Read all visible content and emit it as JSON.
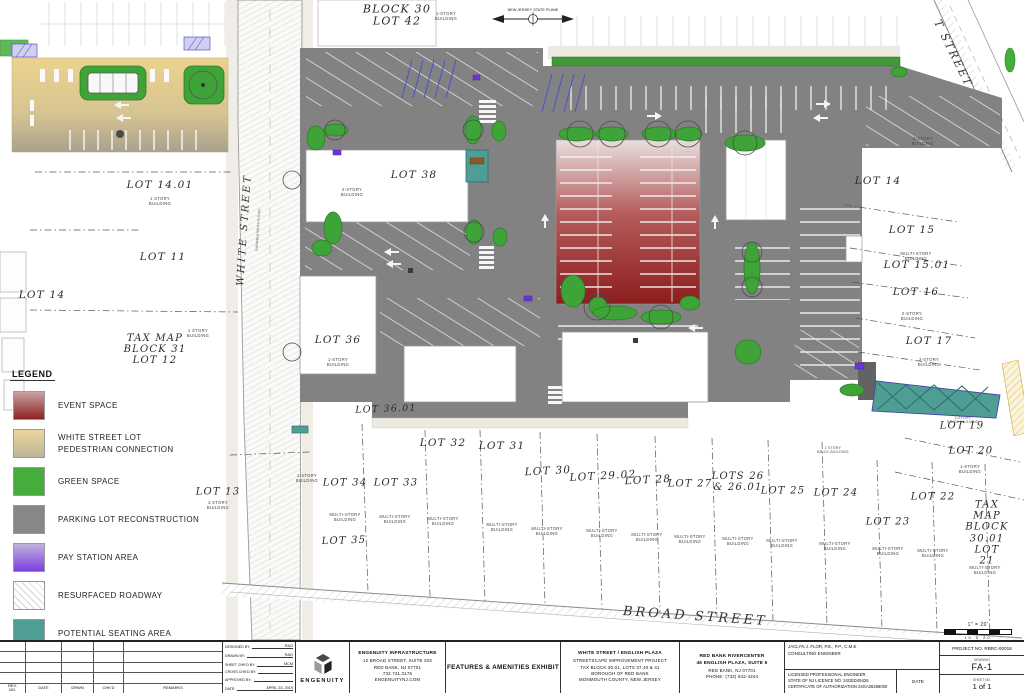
{
  "legend": {
    "title": "LEGEND",
    "items": [
      {
        "label": "EVENT SPACE",
        "label2": "",
        "style": "gradient",
        "colors": [
          "#c9a3a3",
          "#8e2121"
        ]
      },
      {
        "label": "WHITE STREET LOT",
        "label2": "PEDESTRIAN CONNECTION",
        "style": "gradient",
        "colors": [
          "#ecd79b",
          "#bdb49b"
        ]
      },
      {
        "label": "GREEN SPACE",
        "label2": "",
        "style": "solid",
        "colors": [
          "#44ad3c",
          "#44ad3c"
        ]
      },
      {
        "label": "PARKING LOT RECONSTRUCTION",
        "label2": "",
        "style": "solid",
        "colors": [
          "#878787",
          "#878787"
        ]
      },
      {
        "label": "PAY STATION AREA",
        "label2": "",
        "style": "gradient",
        "colors": [
          "#c0b3dc",
          "#7b3fe0"
        ]
      },
      {
        "label": "RESURFACED ROADWAY",
        "label2": "",
        "style": "hatch",
        "colors": [
          "#ffffff",
          "#ffffff"
        ]
      },
      {
        "label": "POTENTIAL SEATING AREA",
        "label2": "",
        "style": "solid",
        "colors": [
          "#4f9e96",
          "#4f9e96"
        ]
      }
    ]
  },
  "plan": {
    "north_label": "NEW JERSEY STATE PLANE",
    "streets": {
      "white": "WHITE STREET",
      "white_sub": "(VARIABLE WIDTH R.O.W.)",
      "broad": "BROAD STREET",
      "right": "T STREET"
    },
    "scale": {
      "ratio": "1\" = 20'",
      "ticks": "10   0        20"
    },
    "lots": [
      {
        "t": "BLOCK 30\nLOT 42",
        "x": 397,
        "y": 16,
        "fs": 11
      },
      {
        "t": "LOT 14.01",
        "x": 160,
        "y": 186
      },
      {
        "t": "LOT 11",
        "x": 163,
        "y": 258
      },
      {
        "t": "LOT 14",
        "x": 42,
        "y": 296
      },
      {
        "t": "TAX MAP\nBLOCK 31\nLOT 12",
        "x": 155,
        "y": 350,
        "fs": 10
      },
      {
        "t": "LOT 13",
        "x": 218,
        "y": 492,
        "fs": 10
      },
      {
        "t": "LOT 38",
        "x": 414,
        "y": 176
      },
      {
        "t": "LOT 36",
        "x": 338,
        "y": 341
      },
      {
        "t": "LOT 36.01",
        "x": 386,
        "y": 410,
        "fs": 9.5,
        "rot": -2
      },
      {
        "t": "LOT 34",
        "x": 345,
        "y": 483,
        "fs": 10
      },
      {
        "t": "LOT 33",
        "x": 396,
        "y": 483,
        "fs": 10
      },
      {
        "t": "LOT 35",
        "x": 344,
        "y": 541,
        "fs": 10,
        "rot": -2
      },
      {
        "t": "LOT 32",
        "x": 443,
        "y": 444
      },
      {
        "t": "LOT 31",
        "x": 502,
        "y": 447
      },
      {
        "t": "LOT 30",
        "x": 548,
        "y": 472,
        "rot": -3
      },
      {
        "t": "LOT 29.02",
        "x": 603,
        "y": 477,
        "rot": -3
      },
      {
        "t": "LOT 28",
        "x": 648,
        "y": 481,
        "rot": -3
      },
      {
        "t": "LOT 27",
        "x": 690,
        "y": 484,
        "fs": 10
      },
      {
        "t": "LOTS 26\n& 26.01",
        "x": 738,
        "y": 482,
        "fs": 10
      },
      {
        "t": "LOT 25",
        "x": 783,
        "y": 491,
        "fs": 10
      },
      {
        "t": "LOT 24",
        "x": 836,
        "y": 493,
        "fs": 10
      },
      {
        "t": "LOT 23",
        "x": 888,
        "y": 522,
        "fs": 10
      },
      {
        "t": "LOT 22",
        "x": 933,
        "y": 497,
        "fs": 10
      },
      {
        "t": "LOT 20",
        "x": 971,
        "y": 451,
        "fs": 10
      },
      {
        "t": "LOT 19",
        "x": 962,
        "y": 426,
        "fs": 10
      },
      {
        "t": "TAX MAP\nBLOCK 30.01\nLOT 21",
        "x": 987,
        "y": 533,
        "fs": 10
      },
      {
        "t": "LOT 14",
        "x": 878,
        "y": 182
      },
      {
        "t": "LOT 15",
        "x": 912,
        "y": 231
      },
      {
        "t": "LOT 15.01",
        "x": 917,
        "y": 266
      },
      {
        "t": "LOT 16",
        "x": 916,
        "y": 293
      },
      {
        "t": "LOT 17",
        "x": 929,
        "y": 342
      }
    ],
    "buildings": [
      {
        "t": "1 STORY\nBUILDING",
        "x": 160,
        "y": 201
      },
      {
        "t": "2-STORY\nBUILDING",
        "x": 352,
        "y": 192
      },
      {
        "t": "1-STORY\nBUILDING",
        "x": 446,
        "y": 16
      },
      {
        "t": "1-STORY\nBUILDING",
        "x": 338,
        "y": 362
      },
      {
        "t": "2 STORY\nBUILDING",
        "x": 218,
        "y": 505
      },
      {
        "t": "1 STORY\nBUILDING",
        "x": 198,
        "y": 333
      },
      {
        "t": "1-STORY\nBUILDING",
        "x": 307,
        "y": 478
      },
      {
        "t": "2-STORY\nBUILDING",
        "x": 923,
        "y": 141
      },
      {
        "t": "MULTI-STORY\nBUILDING",
        "x": 916,
        "y": 256
      },
      {
        "t": "2-STORY\nBUILDING",
        "x": 912,
        "y": 316
      },
      {
        "t": "2-STORY\nBUILDING",
        "x": 929,
        "y": 362
      },
      {
        "t": "2 STORY\nBRICK BUILDING",
        "x": 833,
        "y": 450,
        "fs": 3.4
      },
      {
        "t": "2-STORY\nBRICK BUILDING",
        "x": 963,
        "y": 420,
        "fs": 3.4
      },
      {
        "t": "1-STORY\nBUILDING",
        "x": 970,
        "y": 469
      },
      {
        "t": "MULTI-STORY\nBUILDING",
        "x": 345,
        "y": 517
      },
      {
        "t": "MULTI-STORY\nBUILDING",
        "x": 395,
        "y": 519
      },
      {
        "t": "MULTI-STORY\nBUILDING",
        "x": 443,
        "y": 521
      },
      {
        "t": "MULTI-STORY\nBUILDING",
        "x": 502,
        "y": 527
      },
      {
        "t": "MULTI-STORY\nBUILDING",
        "x": 547,
        "y": 531
      },
      {
        "t": "MULTI-STORY\nBUILDING",
        "x": 602,
        "y": 533
      },
      {
        "t": "MULTI-STORY\nBUILDING",
        "x": 647,
        "y": 537
      },
      {
        "t": "MULTI-STORY\nBUILDING",
        "x": 690,
        "y": 539
      },
      {
        "t": "MULTI-STORY\nBUILDING",
        "x": 738,
        "y": 541
      },
      {
        "t": "MULTI-STORY\nBUILDING",
        "x": 782,
        "y": 543
      },
      {
        "t": "MULTI-STORY\nBUILDING",
        "x": 835,
        "y": 546
      },
      {
        "t": "MULTI-STORY\nBUILDING",
        "x": 888,
        "y": 551
      },
      {
        "t": "MULTI-STORY\nBUILDING",
        "x": 933,
        "y": 553
      },
      {
        "t": "MULTI-STORY\nBUILDING",
        "x": 985,
        "y": 570
      }
    ]
  },
  "title_block": {
    "rev_table": {
      "headers": [
        "REV.\nNO.",
        "DATE",
        "DRWN",
        "CHK'D",
        "REMARKS"
      ]
    },
    "approvals": [
      {
        "label": "DESIGNED BY:",
        "value": "RAO"
      },
      {
        "label": "DRAWN BY:",
        "value": "RAO"
      },
      {
        "label": "SHEET CHK'D BY:",
        "value": "MCM"
      },
      {
        "label": "CROSS CHK'D BY:",
        "value": ""
      },
      {
        "label": "APPROVED BY:",
        "value": ""
      },
      {
        "label": "DATE:",
        "value": "APRIL 23, 2019"
      }
    ],
    "logo": {
      "name": "ENGENUITY"
    },
    "firm": {
      "name": "ENGENUITY INFRASTRUCTURE",
      "address1": "12 BROAD STREET, SUITE 203",
      "address2": "RED BANK, NJ 07701",
      "phone": "732.741.3176",
      "web": "ENGENUITYNJ.COM"
    },
    "exhibit_title": "FEATURES & AMENITIES EXHIBIT",
    "project": {
      "line1": "WHITE STREET / ENGLISH PLAZA",
      "line2": "STREETSCAPE IMPROVEMENT PROJECT",
      "line3": "TAX BLOCK 30.01, LOTS 37,40 & 41",
      "line4": "BOROUGH OF RED BANK",
      "line5": "MONMOUTH COUNTY, NEW JERSEY"
    },
    "client": {
      "name": "RED BANK RIVERCENTER",
      "address1": "46 ENGLISH PLAZA, SUITE 6",
      "address2": "RED BANK, NJ  07701",
      "phone": "PHONE: (732) 842-4244"
    },
    "engineer": {
      "name": "JACLYN J. FLOR, P.E., P.P., C.M.E",
      "title": "CONSULTING ENGINEER",
      "license1": "LICENSED PROFESSIONAL ENGINEER",
      "license2": "STATE OF NJ LICENCE NO. 24GED45426",
      "license3": "CERTIFICATE OF AUTHORIZATION 24GA28268000",
      "date_label": "DATE"
    },
    "sheet": {
      "project_no": "PROJECT NO. RBRC-00018",
      "drawing_label": "DRAWING",
      "drawing": "FA-1",
      "sheet_label": "SHEET NO.",
      "sheet": "1 of 1"
    }
  }
}
